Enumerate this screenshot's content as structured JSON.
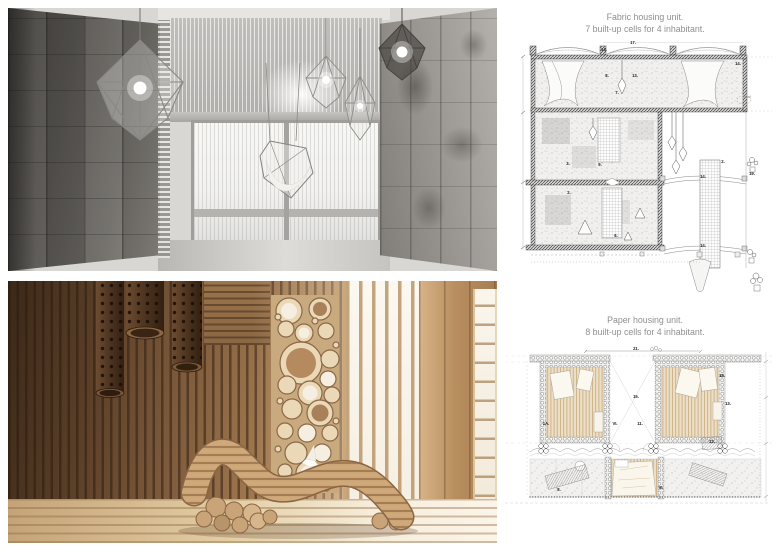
{
  "board": {
    "background": "#ffffff"
  },
  "fabric_plan": {
    "title_line1": "Fabric housing unit.",
    "title_line2": "7 built-up cells for 4 inhabitant.",
    "labels": [
      {
        "text": "17.",
        "x": 633,
        "y": 44
      },
      {
        "text": "14.",
        "x": 604,
        "y": 51
      },
      {
        "text": "14.",
        "x": 738,
        "y": 65
      },
      {
        "text": "8.",
        "x": 607,
        "y": 77
      },
      {
        "text": "13.",
        "x": 635,
        "y": 77
      },
      {
        "text": "7.",
        "x": 617,
        "y": 94
      },
      {
        "text": "3.",
        "x": 568,
        "y": 165
      },
      {
        "text": "9.",
        "x": 600,
        "y": 166
      },
      {
        "text": "2.",
        "x": 569,
        "y": 194
      },
      {
        "text": "6.",
        "x": 616,
        "y": 237
      },
      {
        "text": "2.",
        "x": 723,
        "y": 163
      },
      {
        "text": "14.",
        "x": 703,
        "y": 178
      },
      {
        "text": "14.",
        "x": 703,
        "y": 247
      },
      {
        "text": "19.",
        "x": 752,
        "y": 175
      }
    ],
    "notes": [
      {
        "text": "detail",
        "x": 747,
        "y": 98
      }
    ]
  },
  "paper_plan": {
    "title_line1": "Paper housing unit.",
    "title_line2": "8 built-up cells for 4 inhabitant.",
    "scale_note": "cut patra domu nr 09, dule 1:50",
    "labels": [
      {
        "text": "21.",
        "x": 636,
        "y": 350
      },
      {
        "text": "15.",
        "x": 636,
        "y": 398
      },
      {
        "text": "18.",
        "x": 722,
        "y": 377
      },
      {
        "text": "13.",
        "x": 728,
        "y": 405
      },
      {
        "text": "1A.",
        "x": 546,
        "y": 425
      },
      {
        "text": "VI.",
        "x": 615,
        "y": 425
      },
      {
        "text": "11.",
        "x": 640,
        "y": 425
      },
      {
        "text": "8.",
        "x": 559,
        "y": 491
      },
      {
        "text": "VI.",
        "x": 661,
        "y": 489
      },
      {
        "text": "12.",
        "x": 712,
        "y": 443
      }
    ]
  },
  "colors": {
    "title_text": "#8f8f8f",
    "plan_line": "#555555",
    "plan_wood_floor": "#ead9bc",
    "fabric_wall_dark": "#4a4846",
    "fabric_wall_light": "#d8d7d4",
    "window_glow_gray": "#f5f5f3",
    "cardboard_dark": "#3b2818",
    "cardboard_mid": "#96714c",
    "cardboard_light": "#d9c3a2",
    "window_glow_warm": "#faf6ee"
  }
}
